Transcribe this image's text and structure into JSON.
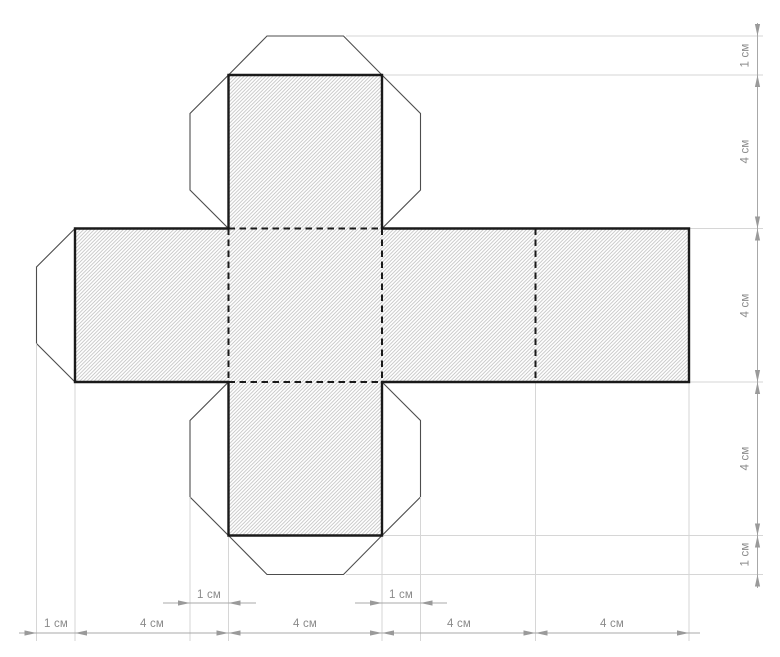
{
  "diagram": {
    "name": "cube-net-development",
    "labels": {
      "right": [
        "1 см",
        "4 см",
        "4 см",
        "4 см",
        "1 см"
      ],
      "bottom": [
        "1 см",
        "4 см",
        "4 см",
        "4 см",
        "4 см"
      ],
      "tabs": [
        "1 см",
        "1 см"
      ]
    },
    "colors": {
      "cut_outline": "#1a1a1a",
      "fold_line": "#1a1a1a",
      "flap_line": "#4d4d4d",
      "hatch_line": "#bfbfbf",
      "extension_line": "#d6d6d6",
      "dimension_line": "#a8a8a8",
      "arrow": "#9a9a9a",
      "label_text": "#8a8a8a",
      "background": "#ffffff"
    }
  }
}
